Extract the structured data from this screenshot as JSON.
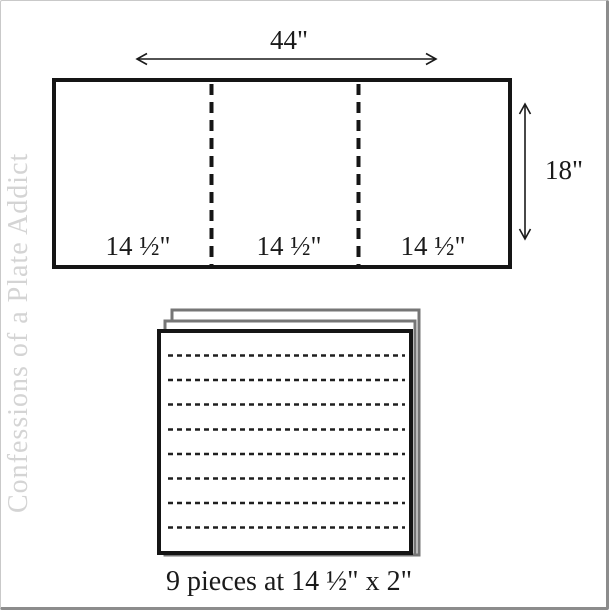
{
  "watermark": {
    "text": "Confessions of a Plate Addict"
  },
  "cutting_diagram": {
    "fabric_width_label": "44\"",
    "fabric_height_label": "18\"",
    "section_labels": [
      "14 ½\"",
      "14 ½\"",
      "14 ½\""
    ]
  },
  "pieces_stack": {
    "caption": "9 pieces at 14 ½\" x 2\""
  },
  "colors": {
    "line": "#1a1a1a",
    "stack_edge": "#767676",
    "watermark_text": "#d4d4d4",
    "frame_light": "#c9c9c9",
    "frame_dark": "#8c8c8c"
  }
}
